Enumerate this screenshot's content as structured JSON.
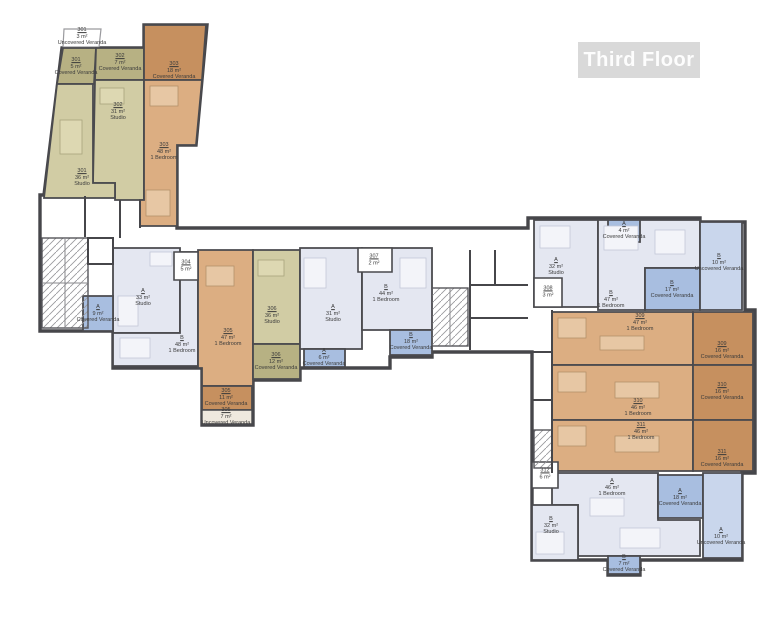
{
  "title": "Third Floor",
  "colors": {
    "wall": "#46464a",
    "olive_unit": "#d1cca4",
    "olive_veranda": "#b7b183",
    "orange_unit": "#dcae82",
    "orange_veranda": "#c6905f",
    "lavender_unit": "#e4e7f1",
    "blue_covered_veranda": "#a8bee0",
    "light_blue_uncovered_veranda": "#c9d6ec",
    "title_box_bg": "#d9d9d9",
    "title_text": "#fdfdfd"
  },
  "rooms": [
    {
      "id": "301",
      "area": "3 m²",
      "type": "Uncovered Veranda"
    },
    {
      "id": "301",
      "area": "5 m²",
      "type": "Covered Veranda"
    },
    {
      "id": "302",
      "area": "7 m²",
      "type": "Covered Veranda"
    },
    {
      "id": "303",
      "area": "18 m²",
      "type": "Covered Veranda"
    },
    {
      "id": "302",
      "area": "31 m²",
      "type": "Studio"
    },
    {
      "id": "303",
      "area": "48 m²",
      "type": "1 Bedroom"
    },
    {
      "id": "301",
      "area": "36 m²",
      "type": "Studio"
    },
    {
      "id": "A",
      "area": "9 m²",
      "type": "Covered Veranda"
    },
    {
      "id": "A",
      "area": "33 m²",
      "type": "Studio"
    },
    {
      "id": "304",
      "area": "5 m²",
      "type": ""
    },
    {
      "id": "B",
      "area": "48 m²",
      "type": "1 Bedroom"
    },
    {
      "id": "305",
      "area": "47 m²",
      "type": "1 Bedroom"
    },
    {
      "id": "306",
      "area": "36 m²",
      "type": "Studio"
    },
    {
      "id": "306",
      "area": "12 m²",
      "type": "Covered Veranda"
    },
    {
      "id": "305",
      "area": "11 m²",
      "type": "Covered Veranda"
    },
    {
      "id": "305",
      "area": "7 m²",
      "type": "Uncovered Veranda"
    },
    {
      "id": "307",
      "area": "2 m²",
      "type": ""
    },
    {
      "id": "A",
      "area": "31 m²",
      "type": "Studio"
    },
    {
      "id": "B",
      "area": "44 m²",
      "type": "1 Bedroom"
    },
    {
      "id": "A",
      "area": "6 m²",
      "type": "Covered Veranda"
    },
    {
      "id": "B",
      "area": "18 m²",
      "type": "Covered Veranda"
    },
    {
      "id": "A",
      "area": "32 m²",
      "type": "Studio"
    },
    {
      "id": "A",
      "area": "4 m²",
      "type": "Covered Veranda"
    },
    {
      "id": "308",
      "area": "3 m²",
      "type": ""
    },
    {
      "id": "B",
      "area": "47 m²",
      "type": "1 Bedroom"
    },
    {
      "id": "B",
      "area": "17 m²",
      "type": "Covered Veranda"
    },
    {
      "id": "B",
      "area": "10 m²",
      "type": "Uncovered Veranda"
    },
    {
      "id": "309",
      "area": "47 m²",
      "type": "1 Bedroom"
    },
    {
      "id": "309",
      "area": "16 m²",
      "type": "Covered Veranda"
    },
    {
      "id": "310",
      "area": "46 m²",
      "type": "1 Bedroom"
    },
    {
      "id": "310",
      "area": "16 m²",
      "type": "Covered Veranda"
    },
    {
      "id": "311",
      "area": "46 m²",
      "type": "1 Bedroom"
    },
    {
      "id": "311",
      "area": "16 m²",
      "type": "Covered Veranda"
    },
    {
      "id": "312",
      "area": "6 m²",
      "type": ""
    },
    {
      "id": "A",
      "area": "46 m²",
      "type": "1 Bedroom"
    },
    {
      "id": "A",
      "area": "18 m²",
      "type": "Covered Veranda"
    },
    {
      "id": "A",
      "area": "10 m²",
      "type": "Uncovered Veranda"
    },
    {
      "id": "B",
      "area": "32 m²",
      "type": "Studio"
    },
    {
      "id": "B",
      "area": "7 m²",
      "type": "Covered Veranda"
    }
  ]
}
